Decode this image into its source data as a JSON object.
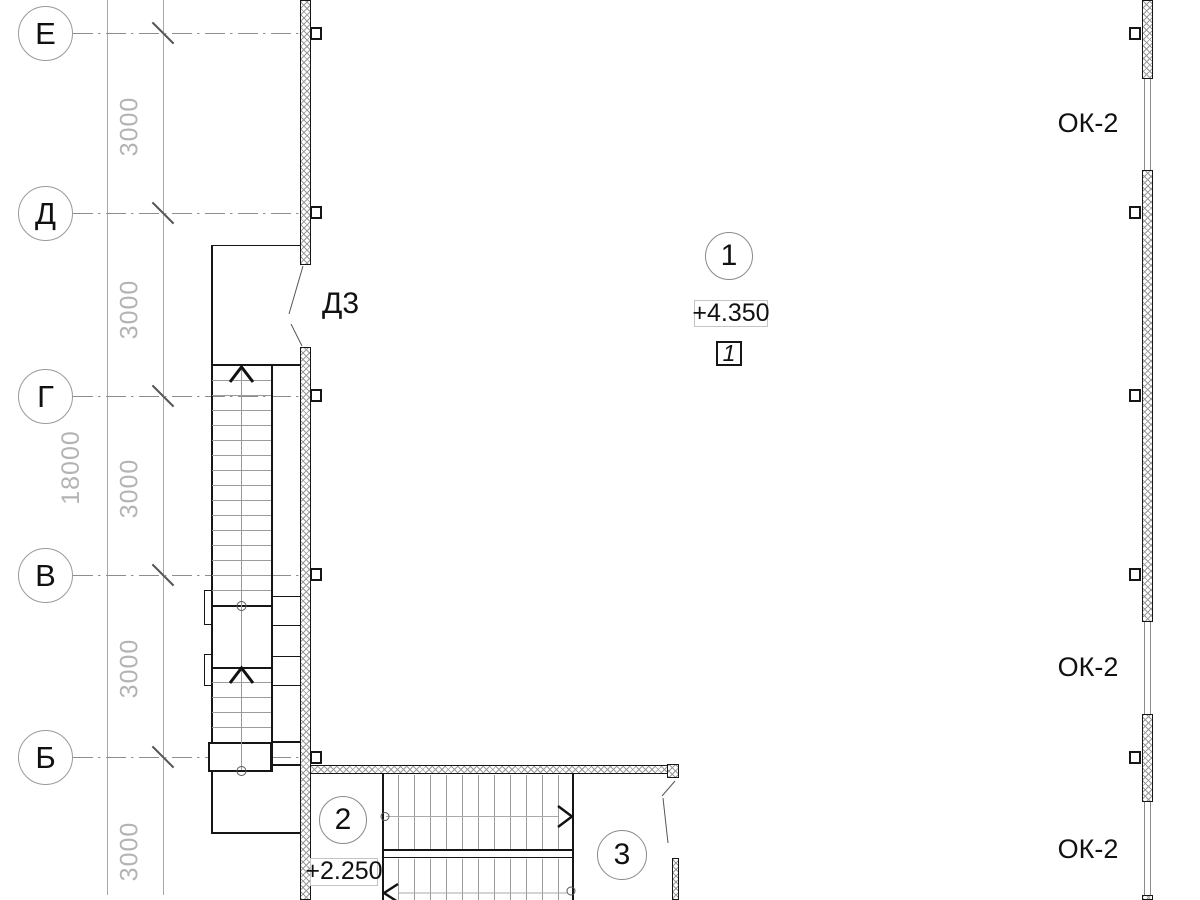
{
  "drawing": {
    "axis_labels": [
      "Е",
      "Д",
      "Г",
      "В",
      "Б"
    ],
    "dim_bay": "3000",
    "dim_overall": "18000",
    "door_label": "Д3",
    "window_label": "ОК-2",
    "markers": {
      "pos1": "1",
      "pos2": "2",
      "pos3": "3",
      "section": "1"
    },
    "elevations": {
      "upper": "+4.350",
      "lower": "+2.250"
    },
    "colors": {
      "ink": "#161616",
      "grid_gray": "#8d8d8d",
      "dim_text_gray": "#b3b3b3",
      "hatch_gray": "#9a9a9a"
    }
  }
}
